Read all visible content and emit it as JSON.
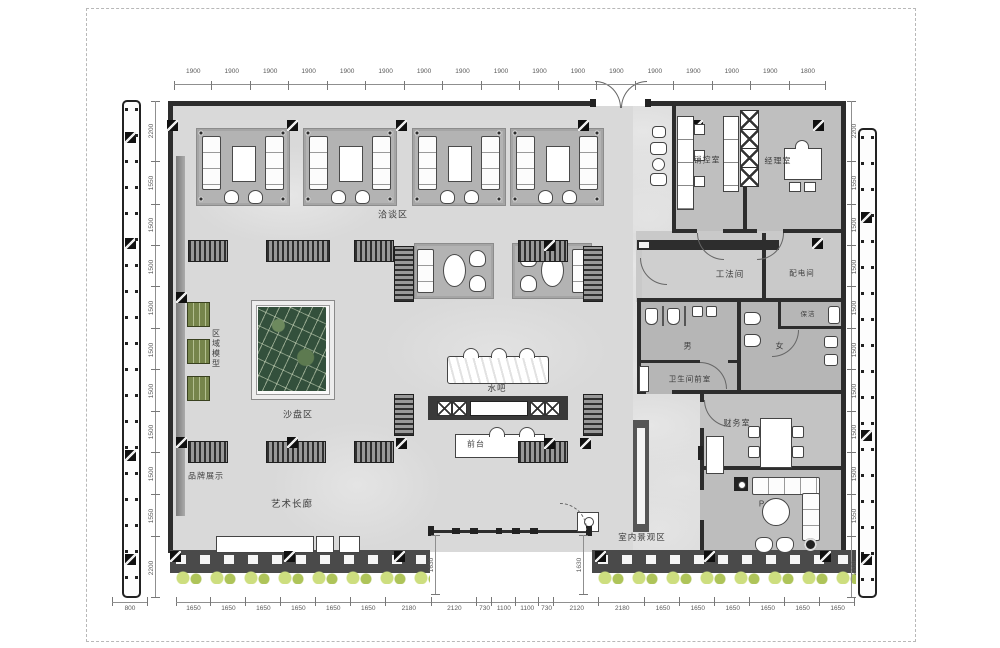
{
  "plan": {
    "rooms": {
      "negotiation_area": "洽谈区",
      "sales_control_room": "销控室",
      "manager_office": "经理室",
      "method_room": "工法间",
      "power_room": "配电间",
      "cleaning_room": "保洁",
      "male_toilet": "男",
      "female_toilet": "女",
      "toilet_anteroom": "卫生间前室",
      "finance_room": "财务室",
      "indoor_landscape": "室内景观区",
      "region_model": "区域模型",
      "brand_display": "品牌展示",
      "sand_table_area": "沙盘区",
      "art_gallery": "艺术长廊",
      "water_bar": "水吧",
      "front_desk": "前台",
      "plant_marker": "P"
    },
    "dimensions": {
      "top": [
        "1900",
        "1900",
        "1900",
        "1900",
        "1900",
        "1900",
        "1900",
        "1900",
        "1900",
        "1900",
        "1900",
        "1900",
        "1900",
        "1900",
        "1900",
        "1900",
        "1800"
      ],
      "left": [
        "2200",
        "1550",
        "1500",
        "1500",
        "1500",
        "1500",
        "1500",
        "1500",
        "1500",
        "1550",
        "2200"
      ],
      "right": [
        "2200",
        "1550",
        "1500",
        "1500",
        "1500",
        "1500",
        "1500",
        "1500",
        "1500",
        "1550",
        "2200"
      ],
      "bottom": [
        "1650",
        "1650",
        "1650",
        "1650",
        "1650",
        "1650",
        "2180",
        "2120",
        "730",
        "1100",
        "1100",
        "730",
        "2120",
        "2180",
        "1650",
        "1650",
        "1650",
        "1650",
        "1650",
        "1650"
      ],
      "bottom_left": [
        "800"
      ],
      "entrance_left": [
        "1630"
      ],
      "entrance_right": [
        "1630"
      ]
    },
    "colors": {
      "wall": "#2d2d2d",
      "hall_floor": "#d9d9d9",
      "wing_floor": "#c6c6c6",
      "shrub_green": "#cdde7f",
      "model_green": "#76854b"
    }
  }
}
